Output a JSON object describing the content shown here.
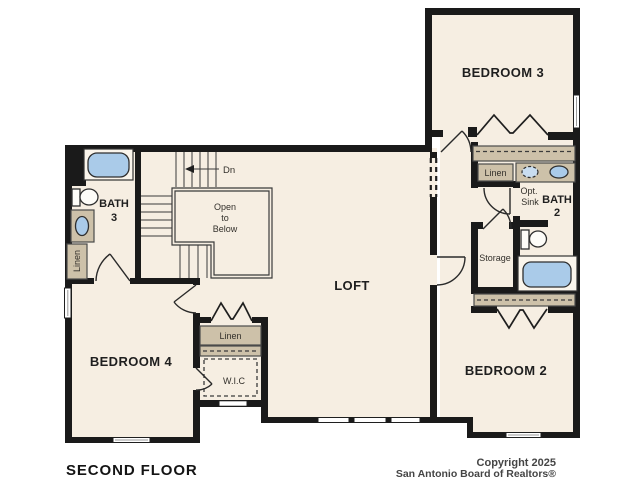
{
  "plan": {
    "title": "SECOND FLOOR",
    "rooms": {
      "bedroom3": "BEDROOM 3",
      "bedroom4": "BEDROOM 4",
      "bedroom2": "BEDROOM 2",
      "loft": "LOFT",
      "bath3_line1": "BATH",
      "bath3_line2": "3",
      "bath2_line1": "BATH",
      "bath2_line2": "2",
      "storage": "Storage",
      "wic": "W.I.C"
    },
    "closets": {
      "linen_bath3": "Linen",
      "linen_hall": "Linen",
      "linen_upstairs": "Linen"
    },
    "stairs": {
      "down_label": "Dn",
      "open_line1": "Open",
      "open_line2": "to",
      "open_line3": "Below"
    },
    "bath2_note": {
      "line1": "Opt.",
      "line2": "Sink"
    },
    "footer": {
      "copyright_line1": "Copyright 2025",
      "copyright_line2": "San Antonio Board of Realtors®"
    },
    "colors": {
      "floor": "#f6eee2",
      "wall": "#1a1a1a",
      "cabinet": "#cdc1a9",
      "fixture": "#aacbe9",
      "background": "#ffffff"
    }
  }
}
